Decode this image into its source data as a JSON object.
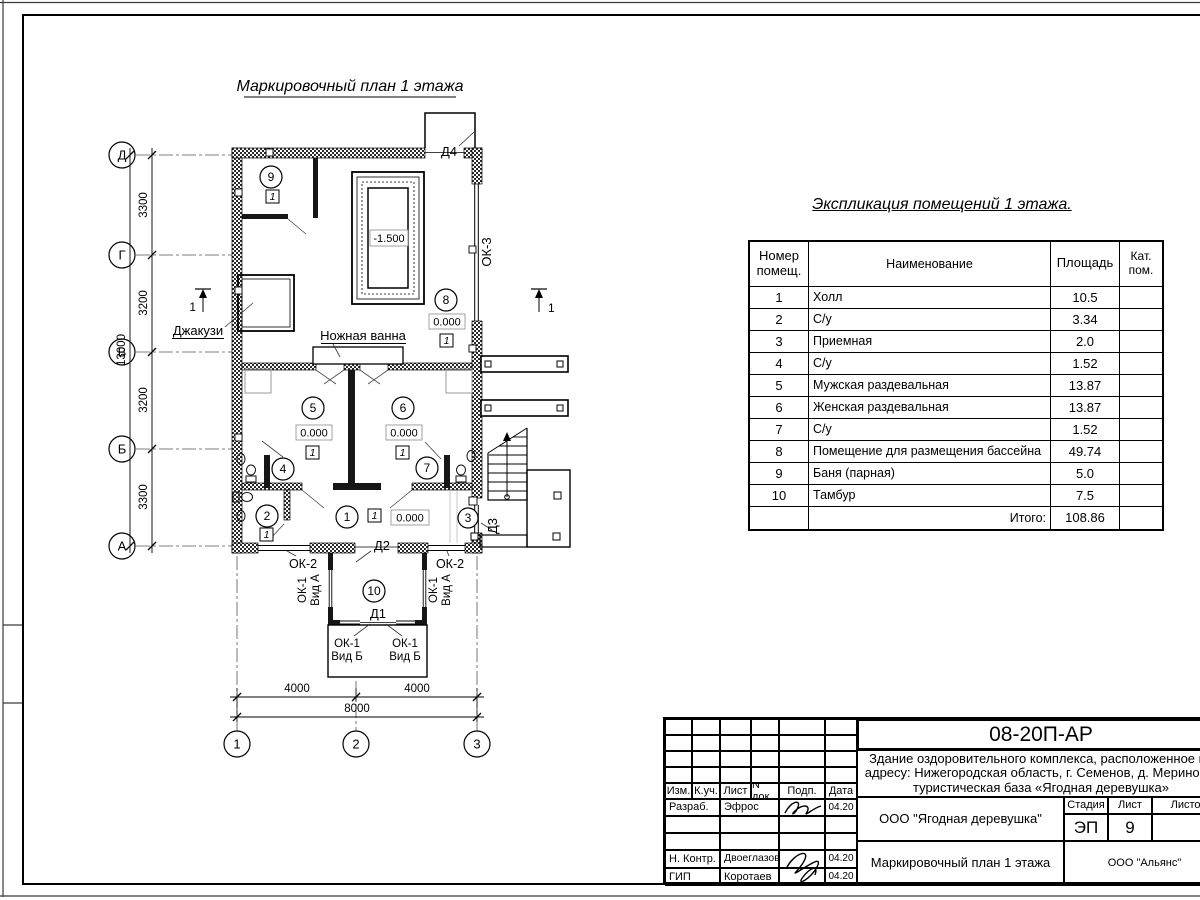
{
  "plan": {
    "title": "Маркировочный план 1 этажа",
    "axes_h": [
      "Д",
      "Г",
      "В",
      "Б",
      "А"
    ],
    "axes_v": [
      "1",
      "2",
      "3"
    ],
    "dims_v": [
      "3300",
      "3200",
      "3200",
      "3300"
    ],
    "dim_v_total": "13000",
    "dims_h": [
      "4000",
      "4000"
    ],
    "dim_h_total": "8000",
    "rooms": [
      "1",
      "2",
      "3",
      "4",
      "5",
      "6",
      "7",
      "8",
      "9",
      "10"
    ],
    "elev_zero": "0.000",
    "elev_pool": "-1.500",
    "floor_mark": "1",
    "section_mark": "1",
    "jacuzzi": "Джакузи",
    "foot_bath": "Ножная ванна",
    "doors": {
      "d1": "Д1",
      "d2": "Д2",
      "d3": "Д3",
      "d4": "Д4"
    },
    "windows": {
      "ok1": "ОК-1",
      "ok2": "ОК-2",
      "ok3": "ОК-3",
      "view_a": "Вид А",
      "view_b": "Вид Б"
    }
  },
  "schedule": {
    "title": "Экспликация помещений 1 этажа.",
    "col_num": "Номер помещ.",
    "col_name": "Наименование",
    "col_area": "Площадь",
    "col_cat": "Кат. пом.",
    "rows": [
      {
        "num": "1",
        "name": "Холл",
        "area": "10.5"
      },
      {
        "num": "2",
        "name": "С/у",
        "area": "3.34"
      },
      {
        "num": "3",
        "name": "Приемная",
        "area": "2.0"
      },
      {
        "num": "4",
        "name": "С/у",
        "area": "1.52"
      },
      {
        "num": "5",
        "name": "Мужская раздевальная",
        "area": "13.87"
      },
      {
        "num": "6",
        "name": "Женская раздевальная",
        "area": "13.87"
      },
      {
        "num": "7",
        "name": "С/у",
        "area": "1.52"
      },
      {
        "num": "8",
        "name": "Помещение для размещения бассейна",
        "area": "49.74"
      },
      {
        "num": "9",
        "name": "Баня (парная)",
        "area": "5.0"
      },
      {
        "num": "10",
        "name": "Тамбур",
        "area": "7.5"
      }
    ],
    "total_label": "Итого:",
    "total_value": "108.86"
  },
  "titleblock": {
    "code": "08-20П-АР",
    "project_line1": "Здание оздоровительного комплекса, расположенное по",
    "project_line2": "адресу: Нижегородская область, г. Семенов, д. Мериново,",
    "project_line3": "туристическая база «Ягодная деревушка»",
    "col_izm": "Изм.",
    "col_kuch": "К.уч.",
    "col_list": "Лист",
    "col_ndok": "N док.",
    "col_podp": "Подп.",
    "col_data": "Дата",
    "row_razrab": "Разраб.",
    "razrab_name": "Эфрос",
    "row_nkontr": "Н. Контр.",
    "nkontr_name": "Двоеглазов",
    "row_gip": "ГИП",
    "gip_name": "Коротаев",
    "date": "04.20",
    "org": "ООО \"Ягодная деревушка\"",
    "stage_label": "Стадия",
    "sheet_label": "Лист",
    "sheets_label": "Листов",
    "stage": "ЭП",
    "sheet": "9",
    "doc_name": "Маркировочный план 1 этажа",
    "company": "ООО \"Альянс\""
  }
}
